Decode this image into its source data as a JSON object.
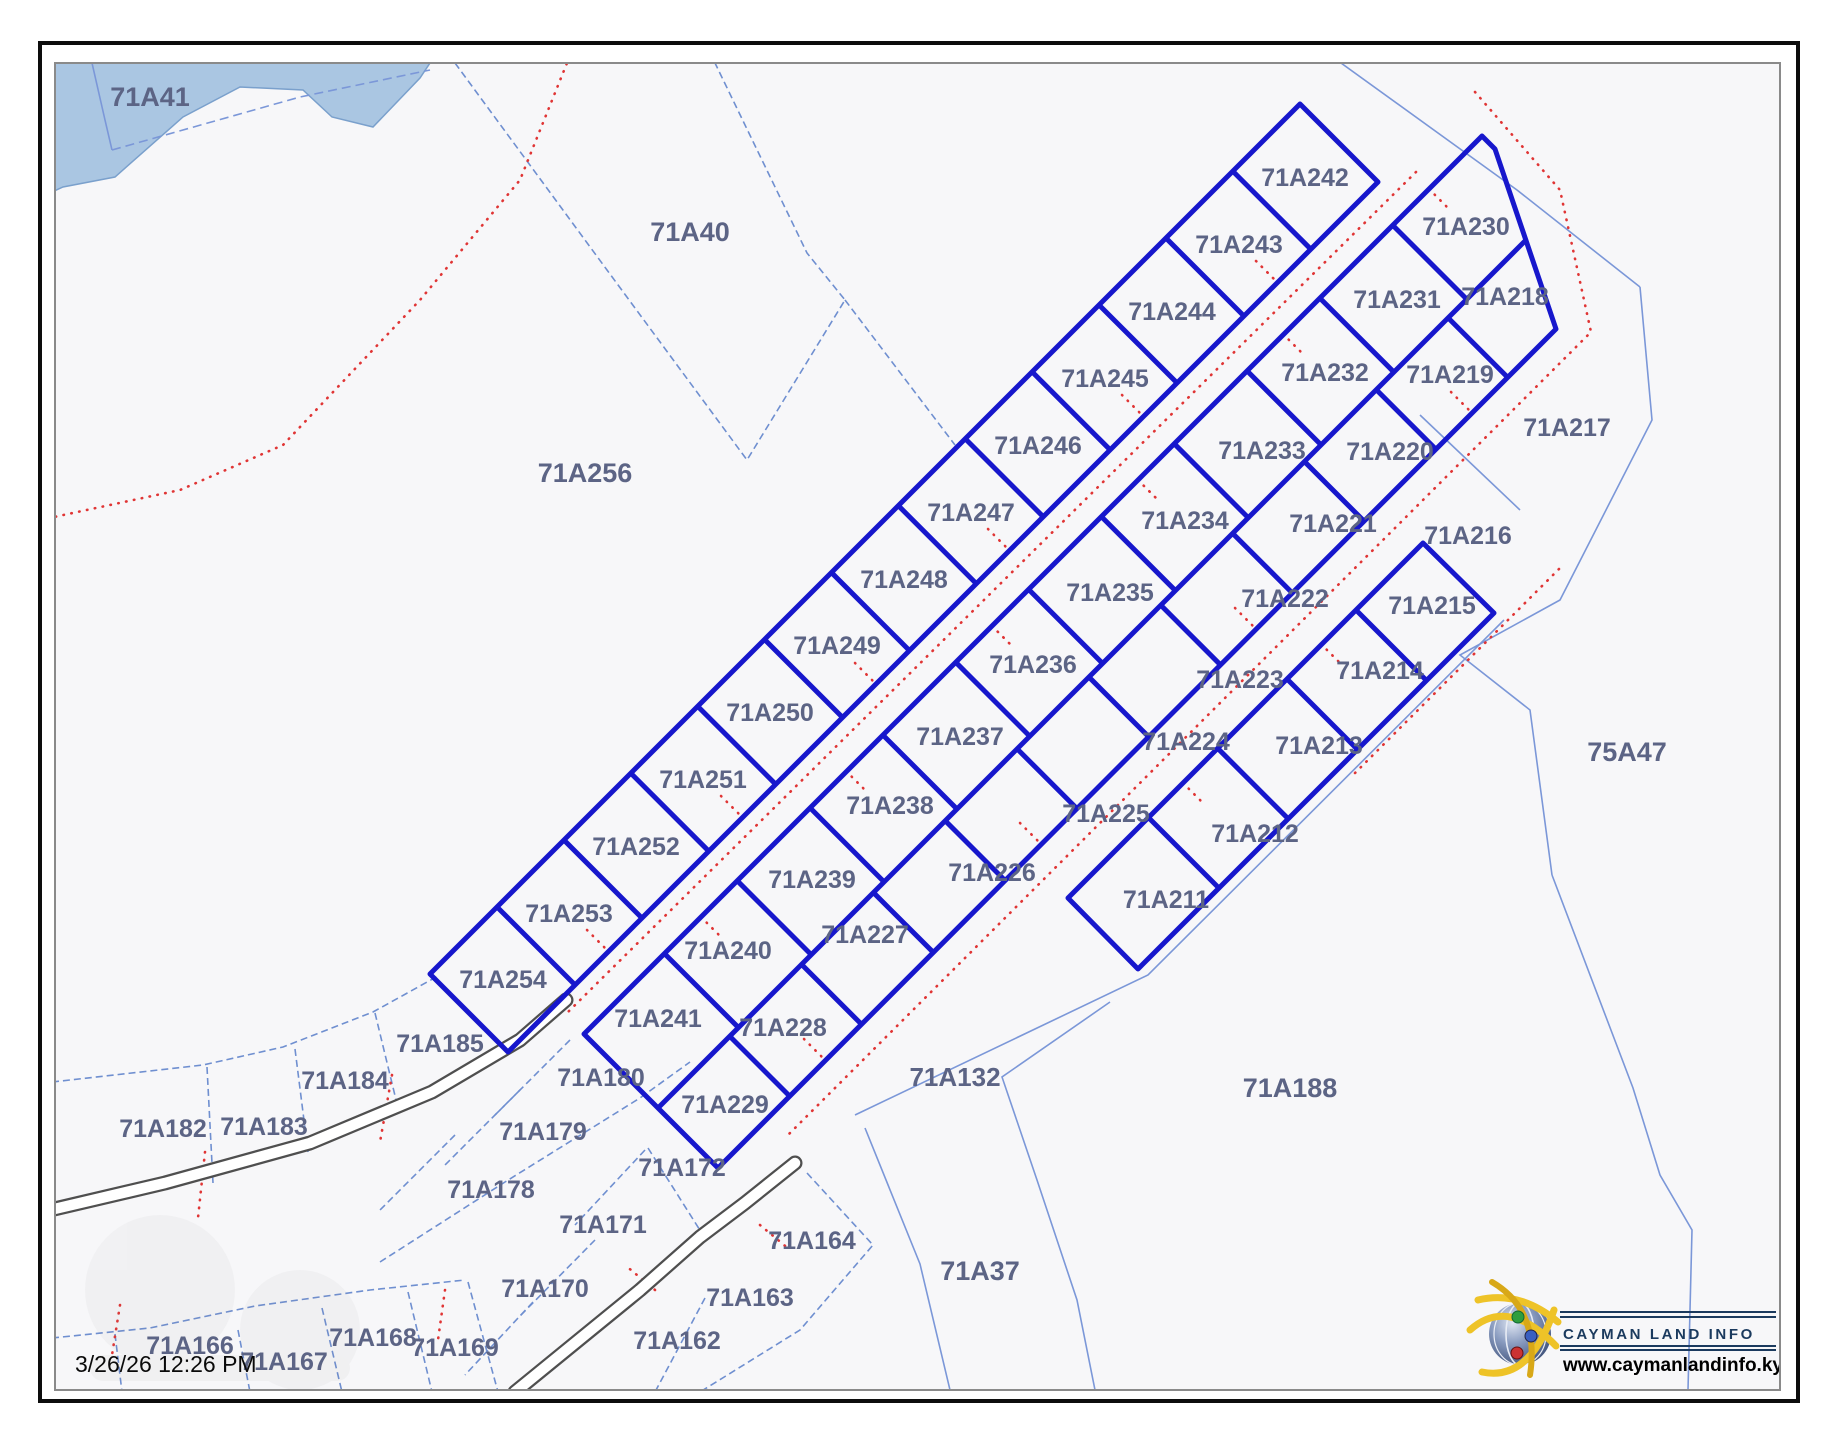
{
  "map": {
    "timestamp": "3/26/26 12:26 PM",
    "logo": {
      "name": "CAYMAN LAND INFO",
      "url": "www.caymanlandinfo.ky"
    },
    "colors": {
      "bold_parcel_blue": "#1717cc",
      "thin_parcel_blue": "#7b97d8",
      "road_centerline_red": "#e03535",
      "water_blue": "#aac6e2",
      "label_color": "#5c6485"
    },
    "labels": [
      {
        "t": "71A41",
        "x": 150,
        "y": 97,
        "s": 27
      },
      {
        "t": "71A40",
        "x": 690,
        "y": 232,
        "s": 27
      },
      {
        "t": "71A256",
        "x": 585,
        "y": 473,
        "s": 27
      },
      {
        "t": "75A47",
        "x": 1627,
        "y": 752,
        "s": 27
      },
      {
        "t": "71A188",
        "x": 1290,
        "y": 1088,
        "s": 27
      },
      {
        "t": "71A132",
        "x": 955,
        "y": 1077,
        "s": 26
      },
      {
        "t": "71A37",
        "x": 980,
        "y": 1271,
        "s": 27
      },
      {
        "t": "71A242",
        "x": 1305,
        "y": 178,
        "s": 25
      },
      {
        "t": "71A243",
        "x": 1239,
        "y": 245,
        "s": 25
      },
      {
        "t": "71A244",
        "x": 1172,
        "y": 312,
        "s": 25
      },
      {
        "t": "71A245",
        "x": 1105,
        "y": 379,
        "s": 25
      },
      {
        "t": "71A246",
        "x": 1038,
        "y": 446,
        "s": 25
      },
      {
        "t": "71A247",
        "x": 971,
        "y": 513,
        "s": 25
      },
      {
        "t": "71A248",
        "x": 904,
        "y": 580,
        "s": 25
      },
      {
        "t": "71A249",
        "x": 837,
        "y": 646,
        "s": 25
      },
      {
        "t": "71A250",
        "x": 770,
        "y": 713,
        "s": 25
      },
      {
        "t": "71A251",
        "x": 703,
        "y": 780,
        "s": 25
      },
      {
        "t": "71A252",
        "x": 636,
        "y": 847,
        "s": 25
      },
      {
        "t": "71A253",
        "x": 569,
        "y": 914,
        "s": 25
      },
      {
        "t": "71A254",
        "x": 503,
        "y": 980,
        "s": 25
      },
      {
        "t": "71A230",
        "x": 1466,
        "y": 227,
        "s": 25
      },
      {
        "t": "71A231",
        "x": 1397,
        "y": 300,
        "s": 25
      },
      {
        "t": "71A232",
        "x": 1325,
        "y": 373,
        "s": 25
      },
      {
        "t": "71A233",
        "x": 1262,
        "y": 451,
        "s": 25
      },
      {
        "t": "71A234",
        "x": 1185,
        "y": 521,
        "s": 25
      },
      {
        "t": "71A235",
        "x": 1110,
        "y": 593,
        "s": 25
      },
      {
        "t": "71A236",
        "x": 1033,
        "y": 665,
        "s": 25
      },
      {
        "t": "71A237",
        "x": 960,
        "y": 737,
        "s": 25
      },
      {
        "t": "71A238",
        "x": 890,
        "y": 806,
        "s": 25
      },
      {
        "t": "71A239",
        "x": 812,
        "y": 880,
        "s": 25
      },
      {
        "t": "71A240",
        "x": 728,
        "y": 951,
        "s": 25
      },
      {
        "t": "71A241",
        "x": 658,
        "y": 1019,
        "s": 25
      },
      {
        "t": "71A218",
        "x": 1505,
        "y": 297,
        "s": 25
      },
      {
        "t": "71A219",
        "x": 1450,
        "y": 375,
        "s": 25
      },
      {
        "t": "71A220",
        "x": 1390,
        "y": 452,
        "s": 25
      },
      {
        "t": "71A221",
        "x": 1333,
        "y": 524,
        "s": 25
      },
      {
        "t": "71A222",
        "x": 1285,
        "y": 599,
        "s": 25
      },
      {
        "t": "71A223",
        "x": 1240,
        "y": 680,
        "s": 25
      },
      {
        "t": "71A224",
        "x": 1186,
        "y": 742,
        "s": 25
      },
      {
        "t": "71A225",
        "x": 1106,
        "y": 814,
        "s": 25
      },
      {
        "t": "71A226",
        "x": 992,
        "y": 873,
        "s": 25
      },
      {
        "t": "71A227",
        "x": 865,
        "y": 935,
        "s": 25
      },
      {
        "t": "71A228",
        "x": 783,
        "y": 1028,
        "s": 25
      },
      {
        "t": "71A229",
        "x": 725,
        "y": 1105,
        "s": 25
      },
      {
        "t": "71A211",
        "x": 1166,
        "y": 900,
        "s": 25
      },
      {
        "t": "71A212",
        "x": 1255,
        "y": 834,
        "s": 25
      },
      {
        "t": "71A213",
        "x": 1319,
        "y": 746,
        "s": 25
      },
      {
        "t": "71A214",
        "x": 1380,
        "y": 671,
        "s": 25
      },
      {
        "t": "71A215",
        "x": 1432,
        "y": 606,
        "s": 25
      },
      {
        "t": "71A216",
        "x": 1468,
        "y": 536,
        "s": 25
      },
      {
        "t": "71A217",
        "x": 1567,
        "y": 428,
        "s": 25
      },
      {
        "t": "71A185",
        "x": 440,
        "y": 1044,
        "s": 25
      },
      {
        "t": "71A184",
        "x": 345,
        "y": 1081,
        "s": 25
      },
      {
        "t": "71A183",
        "x": 264,
        "y": 1127,
        "s": 25
      },
      {
        "t": "71A182",
        "x": 163,
        "y": 1129,
        "s": 25
      },
      {
        "t": "71A180",
        "x": 601,
        "y": 1078,
        "s": 25
      },
      {
        "t": "71A179",
        "x": 543,
        "y": 1132,
        "s": 25
      },
      {
        "t": "71A178",
        "x": 491,
        "y": 1190,
        "s": 25
      },
      {
        "t": "71A172",
        "x": 682,
        "y": 1168,
        "s": 25
      },
      {
        "t": "71A171",
        "x": 603,
        "y": 1225,
        "s": 25
      },
      {
        "t": "71A170",
        "x": 545,
        "y": 1289,
        "s": 25
      },
      {
        "t": "71A169",
        "x": 455,
        "y": 1348,
        "s": 25
      },
      {
        "t": "71A168",
        "x": 373,
        "y": 1338,
        "s": 25
      },
      {
        "t": "71A167",
        "x": 284,
        "y": 1362,
        "s": 25
      },
      {
        "t": "71A166",
        "x": 190,
        "y": 1346,
        "s": 25
      },
      {
        "t": "71A164",
        "x": 812,
        "y": 1241,
        "s": 25
      },
      {
        "t": "71A163",
        "x": 750,
        "y": 1298,
        "s": 25
      },
      {
        "t": "71A162",
        "x": 677,
        "y": 1341,
        "s": 25
      }
    ]
  }
}
